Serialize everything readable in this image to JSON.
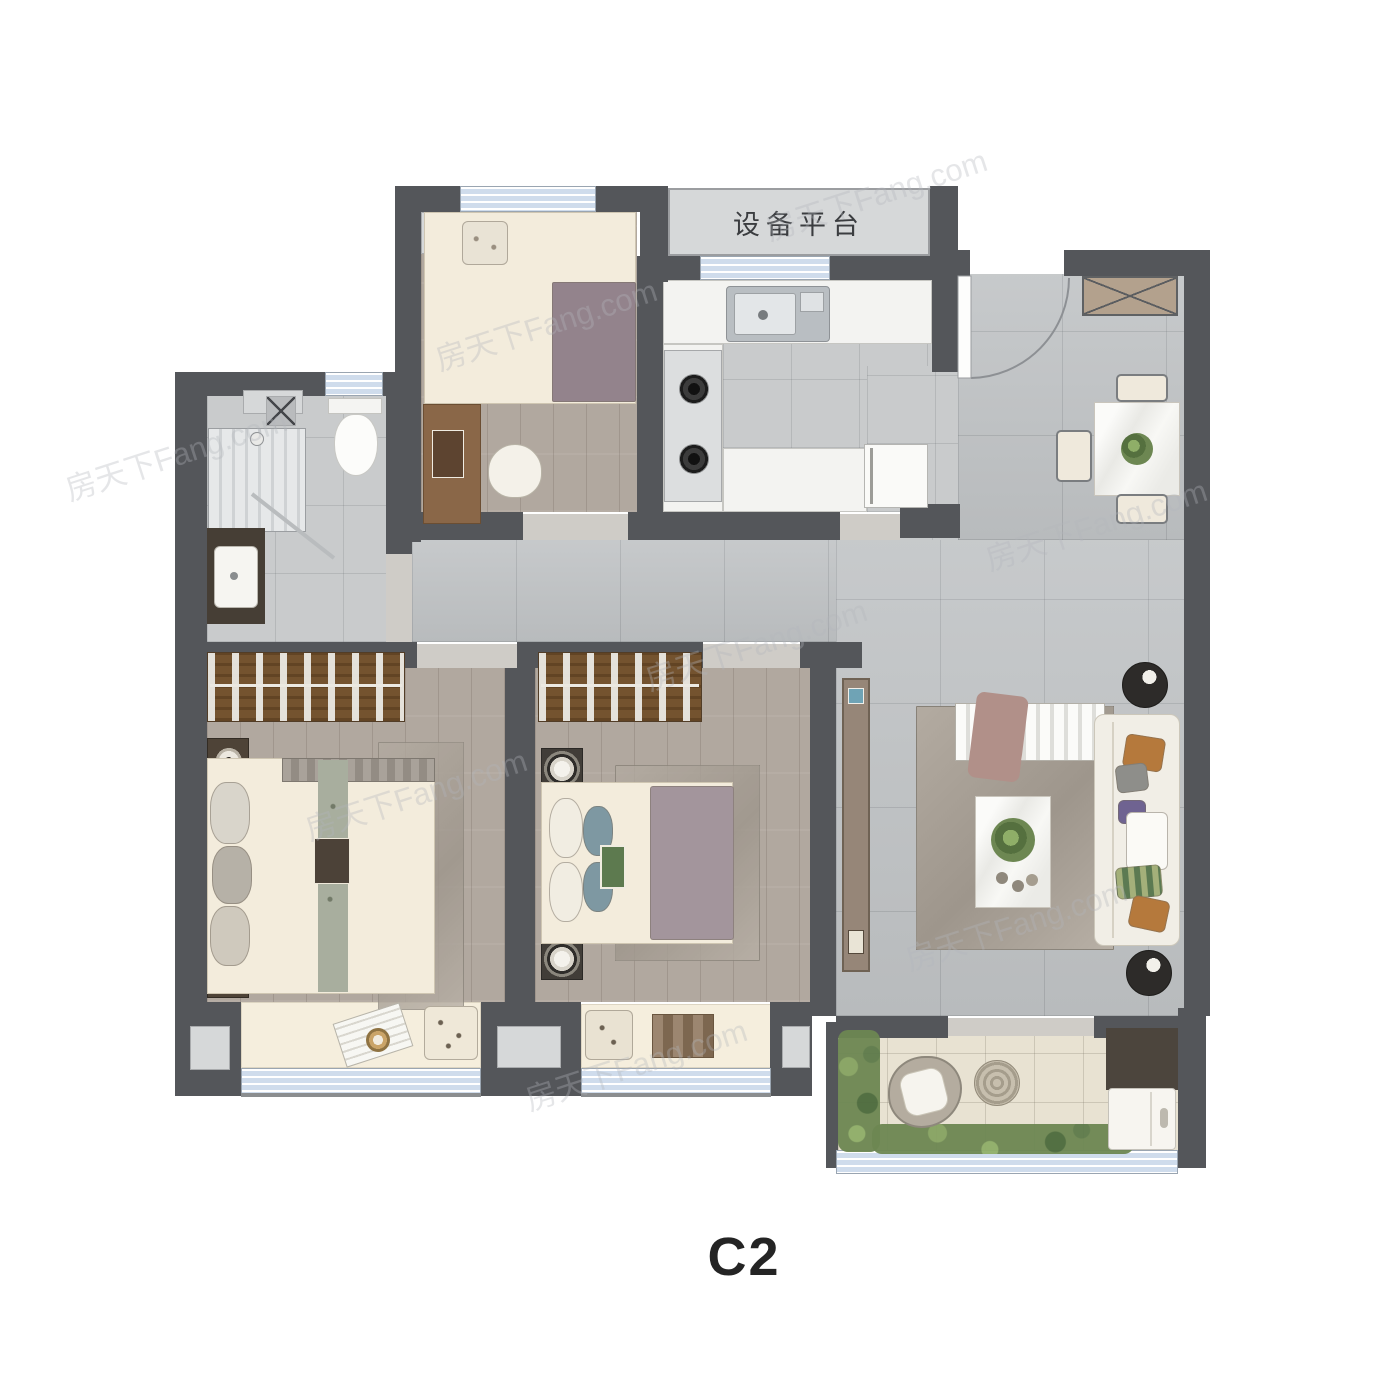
{
  "plan": {
    "unit_label": "C2",
    "equipment_platform_label": "设备平台",
    "watermark_text": "房天下Fang.com",
    "colors": {
      "wall": "#54565a",
      "window": "#cfdcec",
      "tile_floor": "#c2c5c7",
      "wood_floor": "#b1a89f",
      "kitchen_floor": "#c9cbcc",
      "counter_white": "#f3f3f1",
      "bay_seat": "#f5eedd",
      "balcony_floor": "#e8e2d2",
      "wardrobe_wood": "#74532f",
      "ac_platform": "#d6d8d9"
    }
  }
}
